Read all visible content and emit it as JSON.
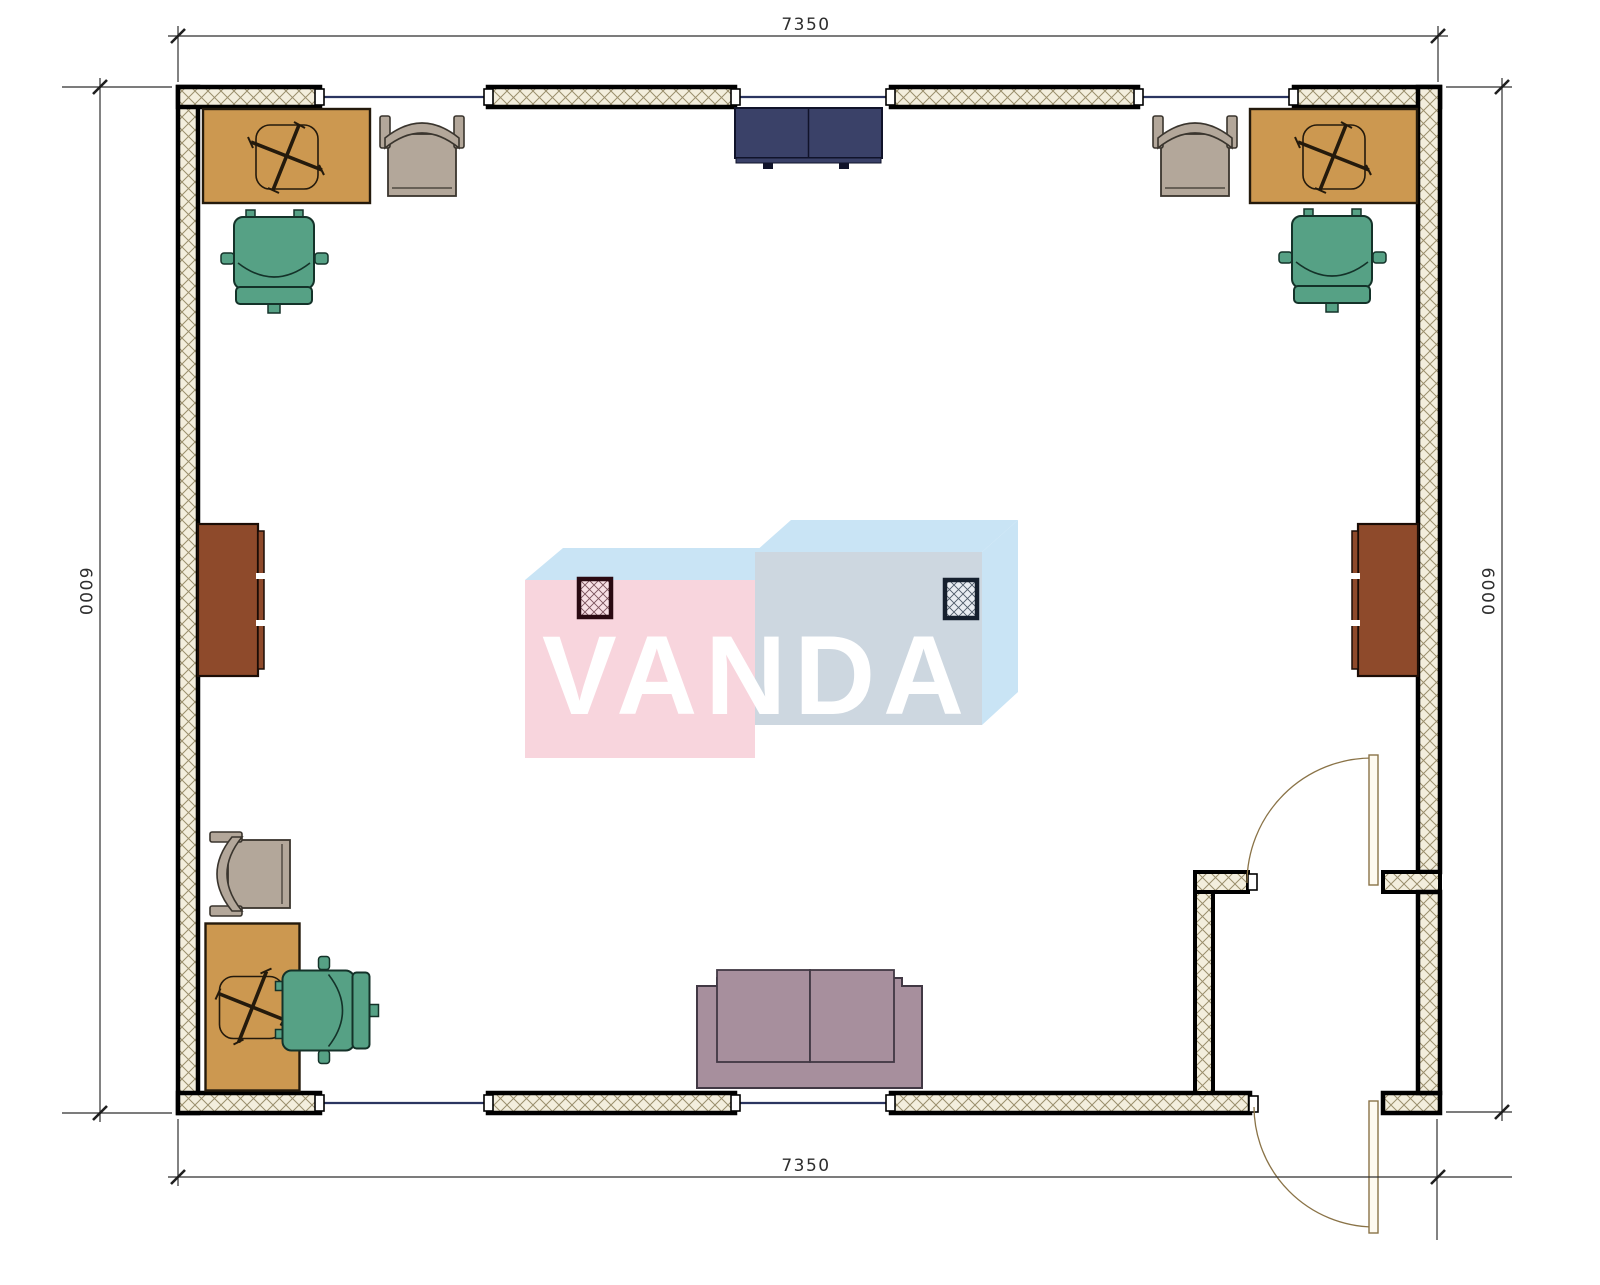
{
  "document": {
    "type": "architectural-floor-plan"
  },
  "dimensions": {
    "top_label": "7350",
    "bottom_label": "7350",
    "left_label": "6000",
    "right_label": "6000"
  },
  "watermark": {
    "text": "VANDA"
  },
  "furniture": {
    "desks": [
      "desk-top-left",
      "desk-top-right",
      "desk-bottom-left"
    ],
    "office_chairs": [
      "office-chair-top-left",
      "office-chair-top-right",
      "office-chair-bottom-left"
    ],
    "armchairs": [
      "armchair-top-left",
      "armchair-top-right",
      "armchair-bottom-left"
    ],
    "cabinets": [
      "sideboard-left-wall",
      "sideboard-right-wall",
      "cabinet-top-center"
    ],
    "sofa": "sofa-bottom-center",
    "columns": [
      "column-left",
      "column-right"
    ],
    "doors": [
      "vestibule-interior-door",
      "entry-exterior-door"
    ],
    "windows": [
      "top-wall-window-1",
      "top-wall-window-2",
      "top-wall-window-3",
      "bottom-wall-window-1",
      "bottom-wall-window-2"
    ]
  },
  "colors": {
    "desk": "#cc9850",
    "desk_line": "#241a0c",
    "ochair": "#56a185",
    "ochair_line": "#143229",
    "armchair": "#b3a79a",
    "armchair_line": "#3a352e",
    "navy": "#3a4168",
    "navy_line": "#10132a",
    "brown": "#8e4a2b",
    "brown_line": "#1b0d06",
    "sofa": "#a78f9d",
    "sofa_line": "#413844",
    "wall_fill": "#f3eedd",
    "wall_hatch": "#9a8e6c",
    "window_line": "#2b3560",
    "door_line": "#8a7347",
    "dim_line": "#2f2f2f",
    "wm_pink": "#f8d5dd",
    "wm_blue": "#cdd7e0",
    "wm_top": "#c9e4f5",
    "col_pink_fill": "#f7e0e5",
    "col_pink_line": "#2a0a12",
    "col_pink_hatch": "#7a525c",
    "col_blue_fill": "#e9edf2",
    "col_blue_line": "#16202e",
    "col_blue_hatch": "#4e5a68"
  }
}
